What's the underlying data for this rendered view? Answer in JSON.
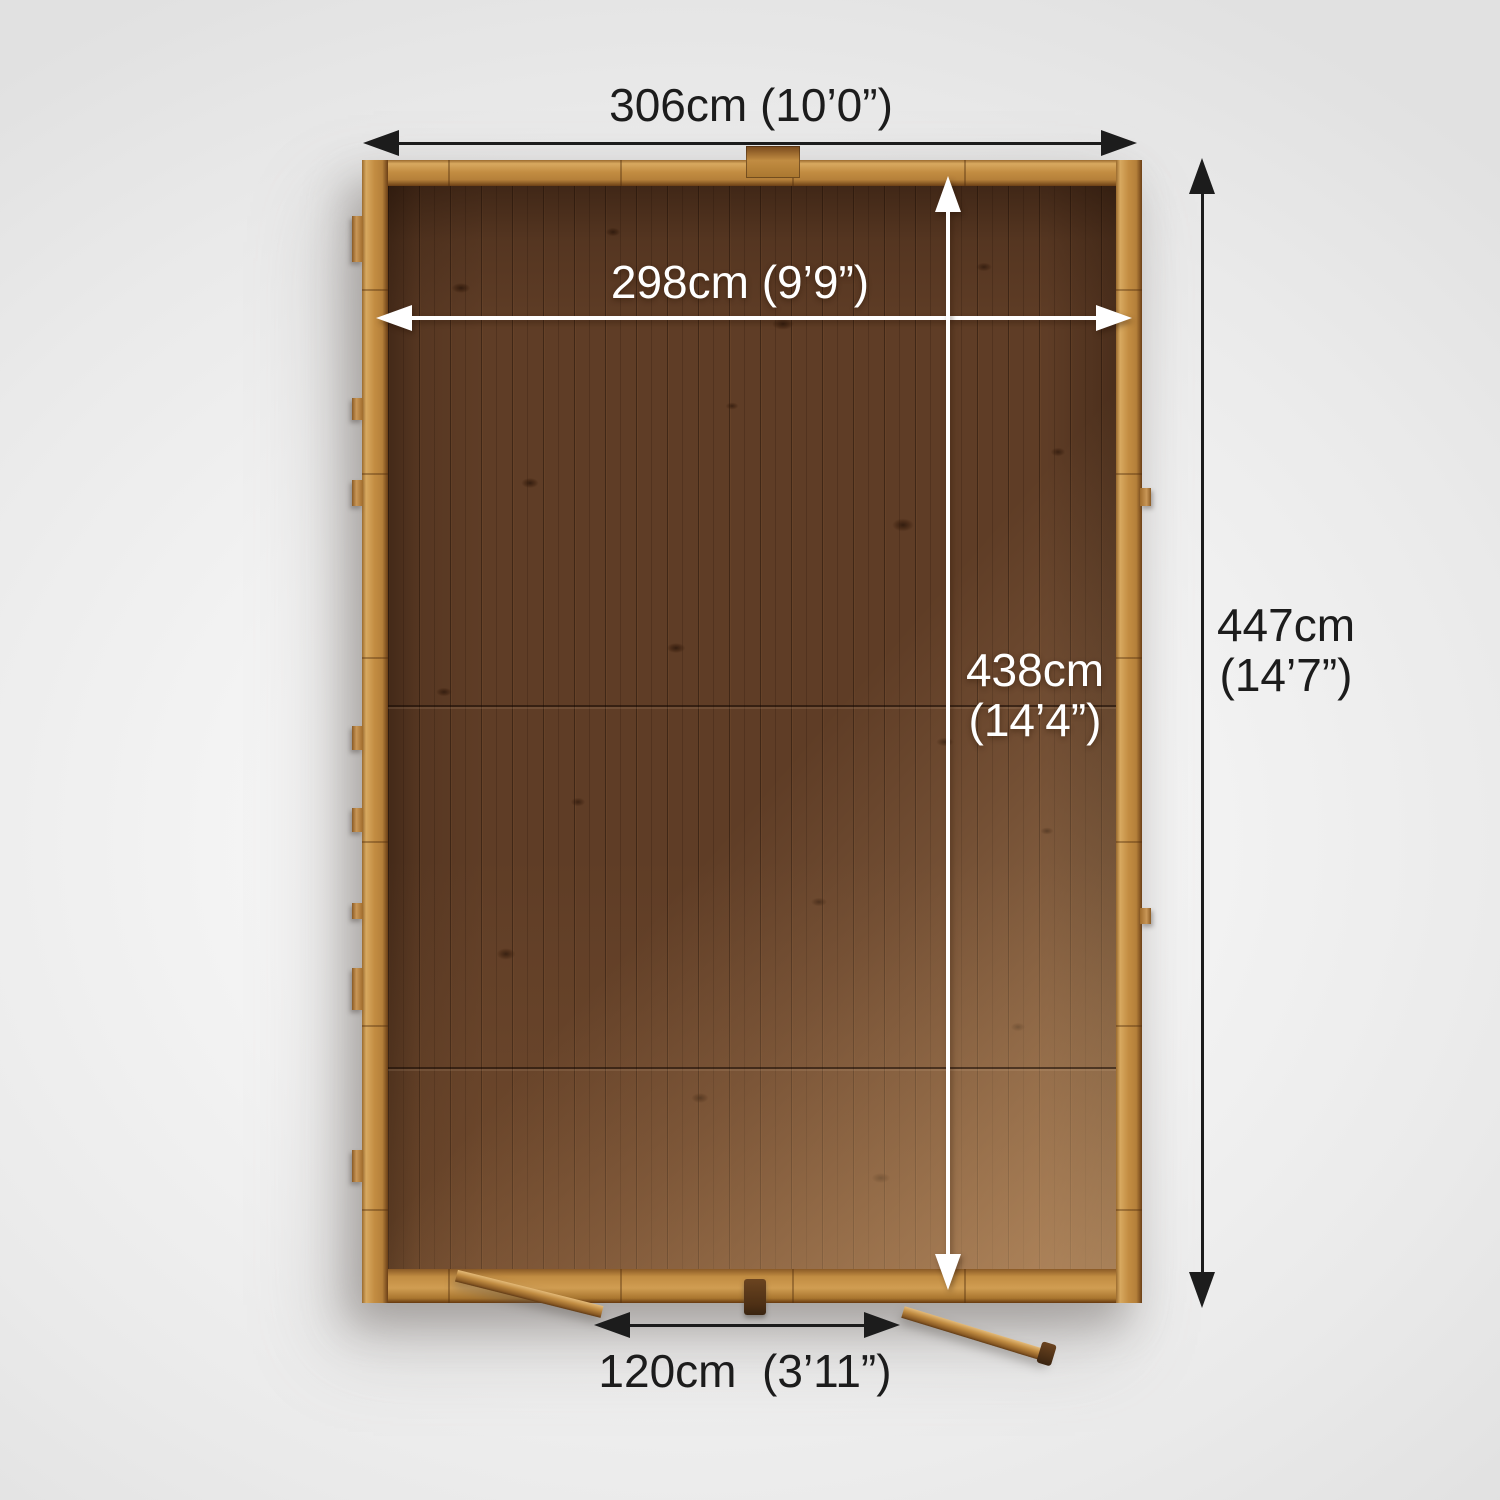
{
  "scene": {
    "description": "Top-down plan view of a wooden shed with double doors open at the front",
    "view": "overhead dimension diagram"
  },
  "dimensions": {
    "external_width": "306cm (10’0”)",
    "internal_width": "298cm (9’9”)",
    "internal_depth": [
      "438cm",
      "(14’4”)"
    ],
    "external_depth": [
      "447cm",
      "(14’7”)"
    ],
    "door_opening_width": "120cm  (3’11”)"
  },
  "colors": {
    "background": "#f0f0f0",
    "annotation_black": "#1c1c1c",
    "annotation_white": "#ffffff",
    "wood_frame": "#c38d42",
    "wood_floor_dark": "#5f3d26",
    "wood_floor_lit": "#8c613b"
  }
}
